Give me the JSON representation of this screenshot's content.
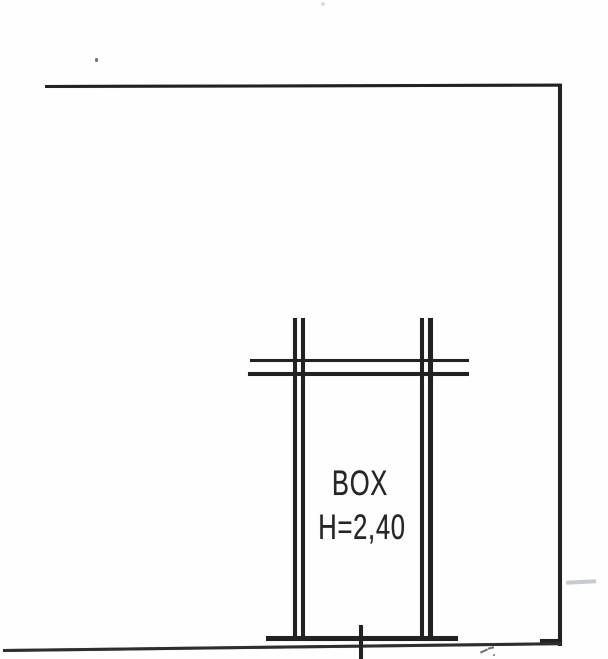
{
  "plan": {
    "room_label": "BOX",
    "height_label": "H=2,40"
  },
  "colors": {
    "ink": "#222222",
    "background": "#fefefe",
    "scan_noise": "#9aa0a4"
  }
}
